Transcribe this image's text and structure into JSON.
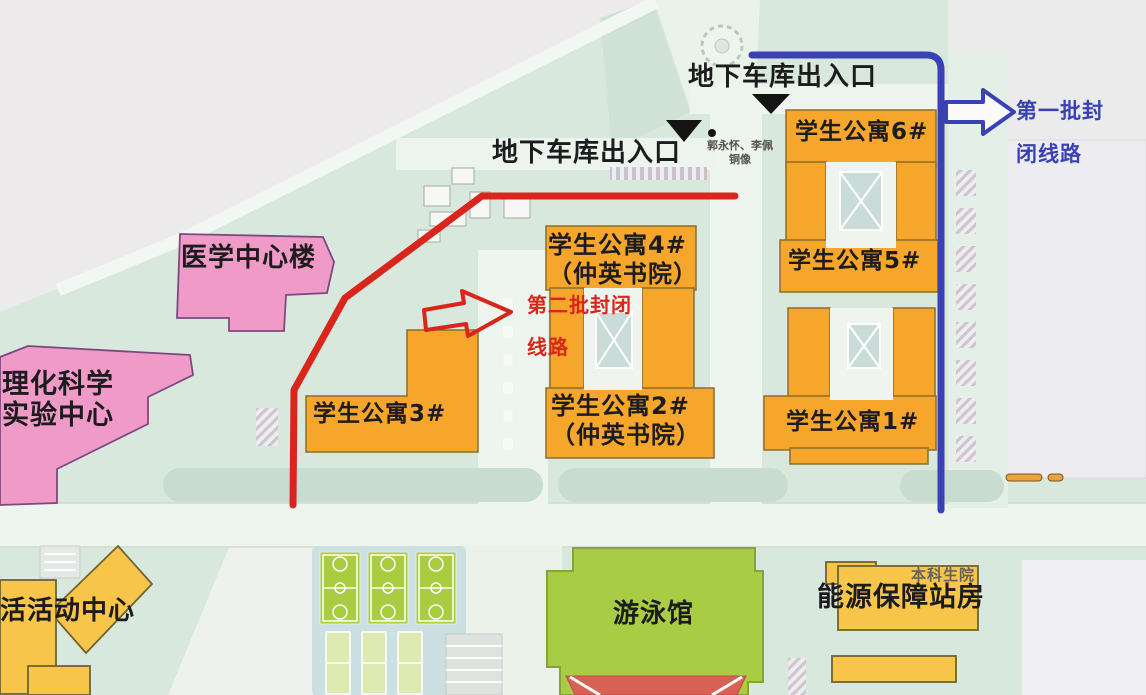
{
  "map": {
    "routes": {
      "first": {
        "name_line1": "第一批封",
        "name_line2": "闭线路",
        "color": "#3a41b5"
      },
      "second": {
        "name_line1": "第二批封闭",
        "name_line2": "线路",
        "color": "#da251c"
      }
    },
    "markers": {
      "garage_top": "地下车库出入口",
      "garage_left": "地下车库出入口",
      "statue_line1": "郭永怀、李佩",
      "statue_line2": "铜像"
    },
    "buildings": {
      "apt6": "学生公寓6#",
      "apt5": "学生公寓5#",
      "apt4_line1": "学生公寓4#",
      "apt4_line2": "（仲英书院）",
      "apt2_line1": "学生公寓2#",
      "apt2_line2": "（仲英书院）",
      "apt3": "学生公寓3#",
      "apt1": "学生公寓1#",
      "medical_center": "医学中心楼",
      "science_lab_line1": "理化科学",
      "science_lab_line2": "实验中心",
      "activity_center": "活活动中心",
      "swimming_pool": "游泳馆",
      "energy_station": "能源保障站房",
      "undergraduate_school": "本科生院"
    },
    "colors": {
      "route_first": "#3a41b5",
      "route_second": "#da251c",
      "apartment_fill": "#f6a62b",
      "public_building_fill": "#f09ac8",
      "service_building_fill": "#f6c54a",
      "court_fill": "#a9cc40",
      "pool_fill": "#a8cc44",
      "pool_roof": "#d96055"
    }
  }
}
